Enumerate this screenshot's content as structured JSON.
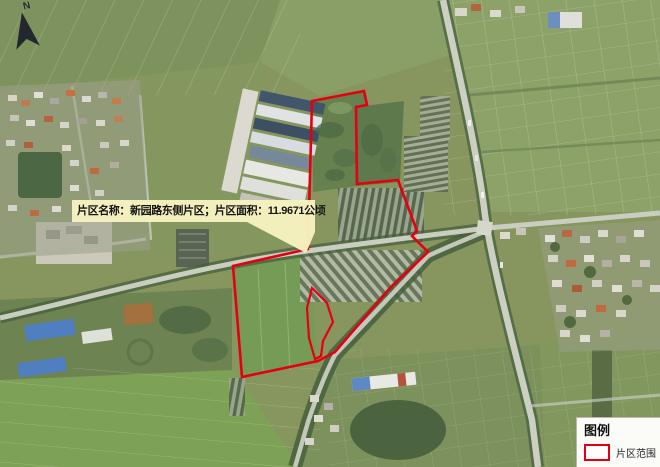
{
  "map": {
    "north_label": "N",
    "boundary_color": "#e50011",
    "callout": {
      "text": "片区名称：新园路东侧片区；片区面积：11.9671公顷",
      "bg_color": "#f6f2c0"
    },
    "legend": {
      "title": "图例",
      "items": [
        {
          "label": "片区范围",
          "swatch_style": "red-outline-rectangle"
        }
      ]
    }
  }
}
